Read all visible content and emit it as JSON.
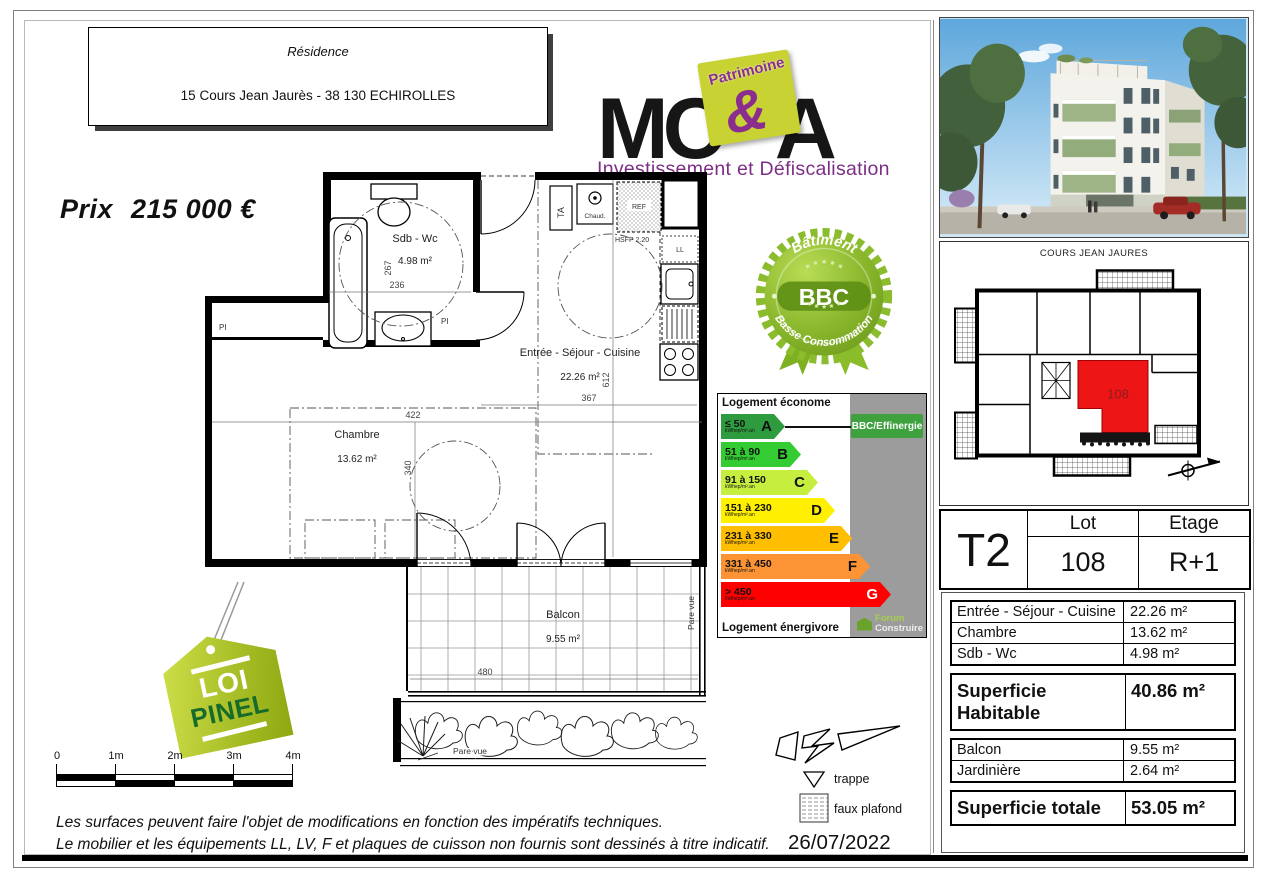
{
  "page": {
    "residence_label": "Résidence",
    "address": "15 Cours Jean Jaurès - 38 130 ECHIROLLES",
    "price_label": "Prix",
    "price_value": "215 000 €",
    "date": "26/07/2022",
    "footer_line1": "Les surfaces peuvent faire l'objet de modifications en fonction des impératifs techniques.",
    "footer_line2": "Le mobilier et les équipements LL, LV, F et plaques de cuisson non fournis sont dessinés à titre indicatif."
  },
  "logo": {
    "mc": "MC",
    "a": "A",
    "ampersand": "&",
    "patrimoine": "Patrimoine",
    "tagline": "Investissement et Défiscalisation"
  },
  "bbc_badge": {
    "top": "Bâtiment",
    "center": "BBC",
    "bottom": "Basse Consommation",
    "stars": "★ ★ ★ ★ ★"
  },
  "energy_chart": {
    "type": "bar",
    "title_top": "Logement économe",
    "title_bottom": "Logement énergivore",
    "unit": "kWhep/m².an",
    "badge": "BBC/Effinergie",
    "brand_line1": "Forum",
    "brand_line2": "Construire",
    "classes": [
      {
        "range": "≤ 50",
        "letter": "A",
        "color": "#2f9b3f"
      },
      {
        "range": "51 à 90",
        "letter": "B",
        "color": "#34cc33"
      },
      {
        "range": "91 à 150",
        "letter": "C",
        "color": "#c6ee3e"
      },
      {
        "range": "151 à 230",
        "letter": "D",
        "color": "#ffef00"
      },
      {
        "range": "231 à 330",
        "letter": "E",
        "color": "#ffbf00"
      },
      {
        "range": "331 à 450",
        "letter": "F",
        "color": "#fc9335"
      },
      {
        "range": "> 450",
        "letter": "G",
        "color": "#fe0000"
      }
    ]
  },
  "floor_plan": {
    "sdb": {
      "name": "Sdb - Wc",
      "area": "4.98 m²",
      "dim_w": "236",
      "dim_h": "267"
    },
    "sejour": {
      "name": "Entrée - Séjour - Cuisine",
      "area": "22.26 m²",
      "dim_w": "367",
      "dim_h": "612"
    },
    "chambre": {
      "name": "Chambre",
      "area": "13.62 m²",
      "dim_w": "422",
      "dim_h": "340"
    },
    "balcon": {
      "name": "Balcon",
      "area": "9.55 m²",
      "dim_w": "480"
    },
    "labels": {
      "ta": "TA",
      "chaud": "Chaud.",
      "ref": "REF",
      "ll": "LL",
      "pi": "PI",
      "hsfp": "HSFP 2.20",
      "pare_vue": "Pare vue"
    }
  },
  "pinel": {
    "word1": "LOI",
    "word2": "PINEL"
  },
  "scale_bar": {
    "labels": [
      "0",
      "1m",
      "2m",
      "3m",
      "4m"
    ]
  },
  "legend": {
    "trappe": "trappe",
    "faux_plafond": "faux plafond"
  },
  "side_panel": {
    "street_label": "COURS JEAN JAURES",
    "unit_number": "108",
    "type_label": "T2",
    "lot_label": "Lot",
    "lot_value": "108",
    "etage_label": "Etage",
    "etage_value": "R+1",
    "rooms": [
      {
        "label": "Entrée - Séjour - Cuisine",
        "value": "22.26 m²"
      },
      {
        "label": "Chambre",
        "value": "13.62 m²"
      },
      {
        "label": "Sdb - Wc",
        "value": "4.98 m²"
      }
    ],
    "habitable_label": "Superficie Habitable",
    "habitable_value": "40.86 m²",
    "annexes": [
      {
        "label": "Balcon",
        "value": "9.55 m²"
      },
      {
        "label": "Jardinière",
        "value": "2.64 m²"
      }
    ],
    "total_label": "Superficie totale",
    "total_value": "53.05 m²"
  }
}
